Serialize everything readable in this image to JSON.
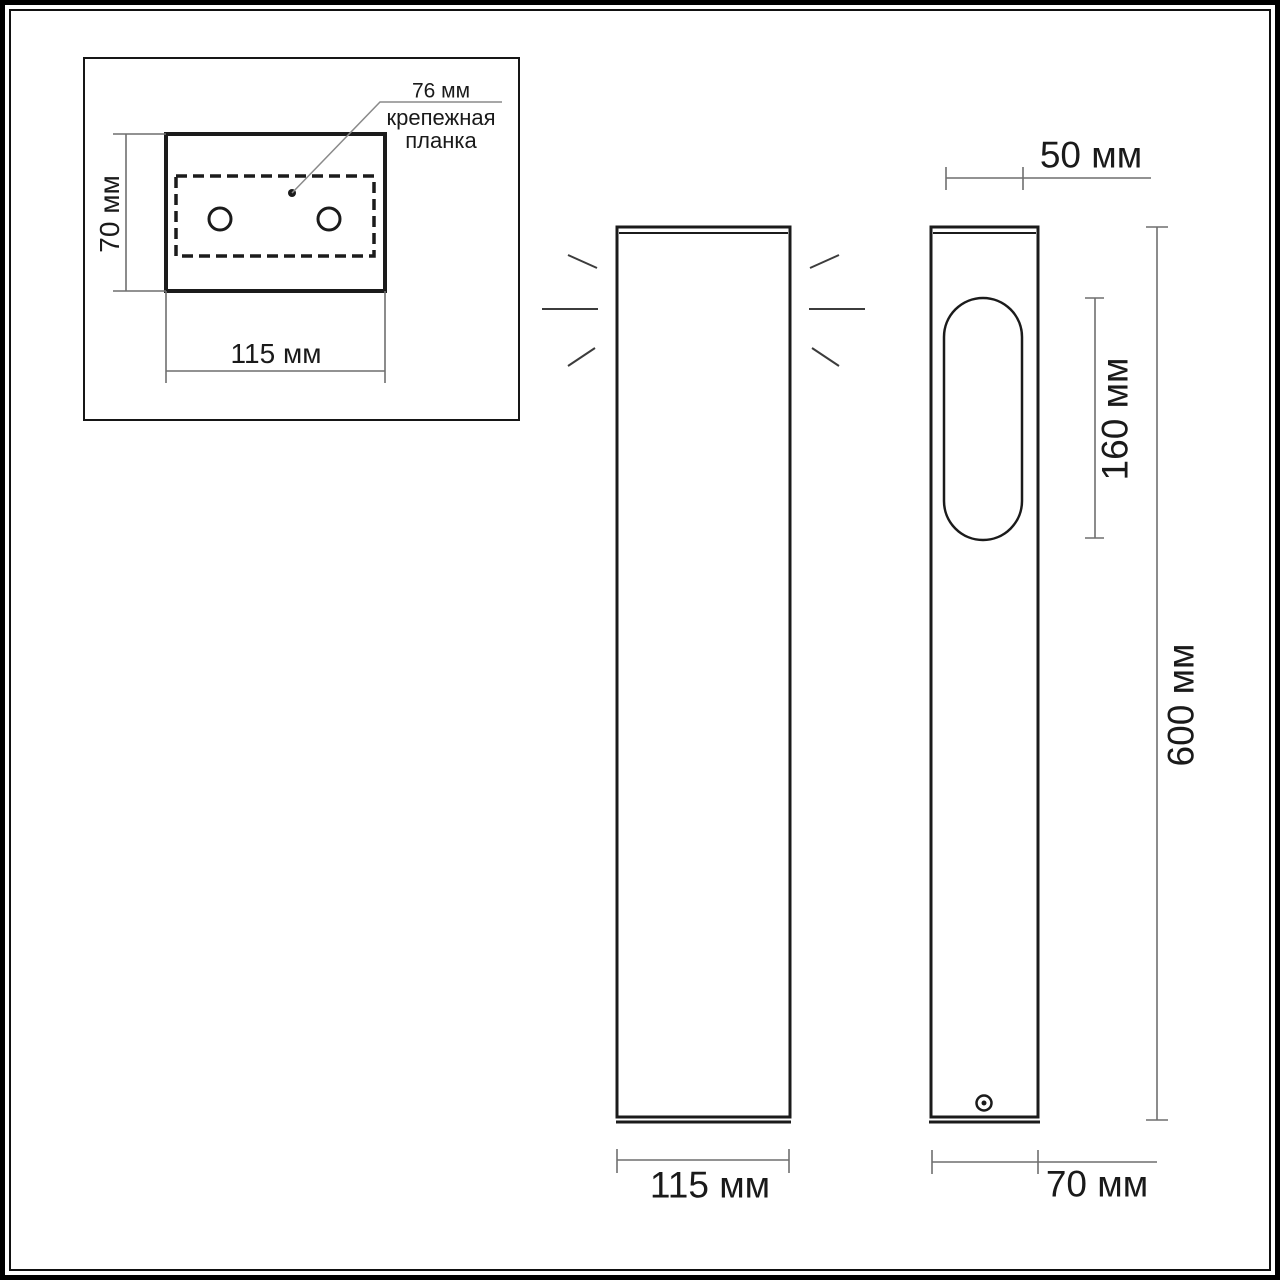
{
  "colors": {
    "background": "#ffffff",
    "line": "#1b1b1b",
    "dimension_line": "#6f6f6f",
    "text": "#1a1a1a"
  },
  "mounting_detail_view": {
    "height_dimension": "70 мм",
    "width_dimension": "115 мм",
    "plate_dimension": "76 мм",
    "plate_label_line1": "крепежная",
    "plate_label_line2": "планка"
  },
  "front_view": {
    "width_dimension": "115 мм"
  },
  "side_view": {
    "top_dimension": "50 мм",
    "window_dimension": "160 мм",
    "height_dimension": "600 мм",
    "depth_dimension": "70 мм"
  }
}
